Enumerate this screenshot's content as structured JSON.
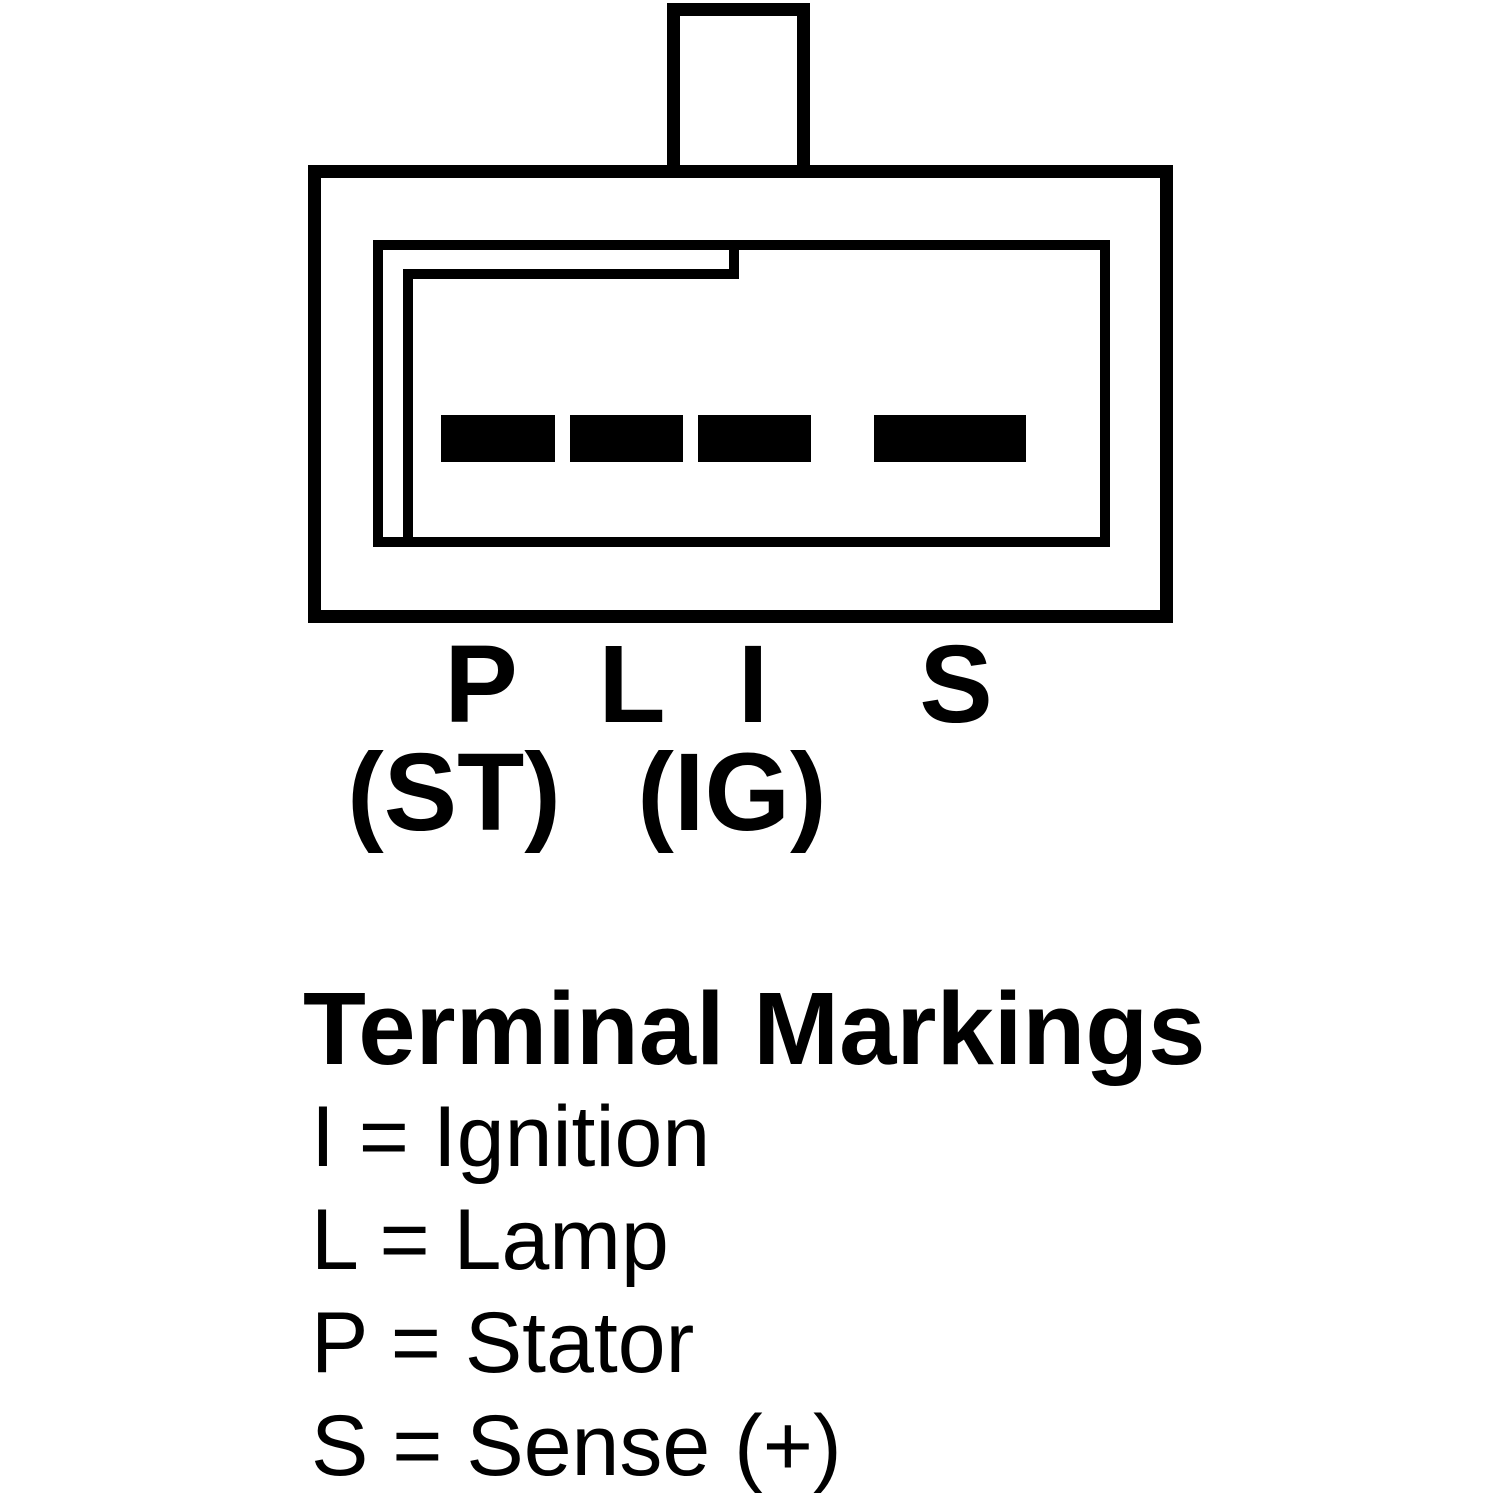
{
  "page": {
    "background_color": "#ffffff",
    "line_color": "#000000"
  },
  "connector": {
    "description": "4-pin alternator plug connector face view with polarization keyway and top tab",
    "terminals": [
      {
        "label": "P"
      },
      {
        "label": "L"
      },
      {
        "label": "I"
      },
      {
        "label": "S"
      }
    ],
    "sub_labels": [
      {
        "label": "(ST)"
      },
      {
        "label": "(IG)"
      }
    ]
  },
  "legend": {
    "title": "Terminal Markings",
    "entries": [
      {
        "text": "I = Ignition"
      },
      {
        "text": "L = Lamp"
      },
      {
        "text": "P = Stator"
      },
      {
        "text": "S = Sense (+)"
      }
    ]
  }
}
